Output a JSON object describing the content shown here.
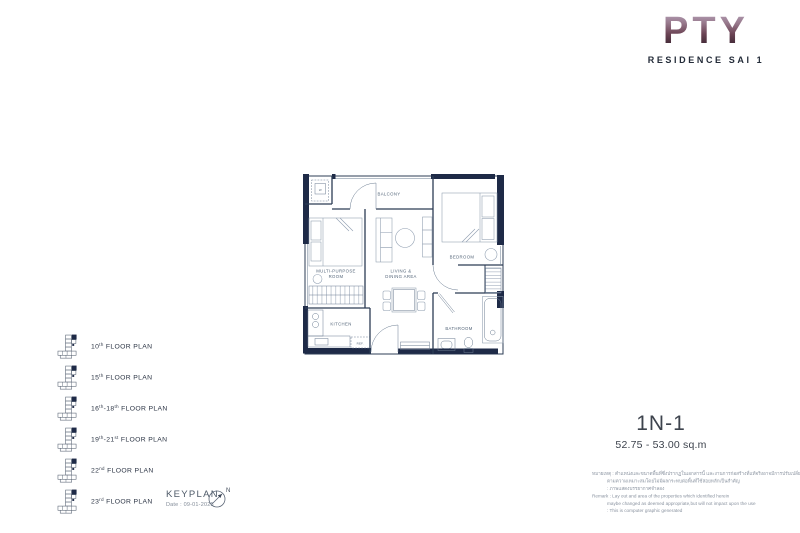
{
  "brand": {
    "name": "PTY",
    "subtitle": "RESIDENCE SAI 1"
  },
  "floor_plans": [
    {
      "parts": [
        {
          "t": "10"
        },
        {
          "t": "th",
          "sup": true
        },
        {
          "t": " FLOOR PLAN"
        }
      ]
    },
    {
      "parts": [
        {
          "t": "15"
        },
        {
          "t": "th",
          "sup": true
        },
        {
          "t": " FLOOR PLAN"
        }
      ]
    },
    {
      "parts": [
        {
          "t": "16"
        },
        {
          "t": "th",
          "sup": true
        },
        {
          "t": "-18"
        },
        {
          "t": "th",
          "sup": true
        },
        {
          "t": " FLOOR PLAN"
        }
      ]
    },
    {
      "parts": [
        {
          "t": "19"
        },
        {
          "t": "th",
          "sup": true
        },
        {
          "t": "-21"
        },
        {
          "t": "st",
          "sup": true
        },
        {
          "t": " FLOOR PLAN"
        }
      ]
    },
    {
      "parts": [
        {
          "t": "22"
        },
        {
          "t": "nd",
          "sup": true
        },
        {
          "t": " FLOOR PLAN"
        }
      ]
    },
    {
      "parts": [
        {
          "t": "23"
        },
        {
          "t": "rd",
          "sup": true
        },
        {
          "t": " FLOOR PLAN"
        }
      ]
    }
  ],
  "keyplan": {
    "title": "KEYPLAN",
    "date": "Date : 09-01-2025",
    "north": "N"
  },
  "unit": {
    "code": "1N-1",
    "area": "52.75 - 53.00 sq.m"
  },
  "plan": {
    "labels": {
      "balcony": "BALCONY",
      "multipurpose_1": "MULTI-PURPOSE",
      "multipurpose_2": "ROOM",
      "living_1": "LIVING &",
      "living_2": "DINING AREA",
      "bedroom": "BEDROOM",
      "kitchen": "KITCHEN",
      "bathroom": "BATHROOM",
      "washer": "W",
      "ref": "REF."
    }
  },
  "remark": {
    "lines": [
      {
        "text": "หมายเหตุ : ตำแหน่งและขนาดพื้นที่ซึ่งปรากฏในเอกสารนี้ และงานการก่อสร้างที่แท้จริงอาจมีการปรับเปลี่ยนได้",
        "indent": false
      },
      {
        "text": "ตามความเหมาะสมโดยไม่มีผลกระทบต่อพื้นที่ใช้สอยหลักเป็นสำคัญ",
        "indent": true
      },
      {
        "text": ": ภาพแสดงบรรยากาศจำลอง",
        "indent": true
      },
      {
        "text": "Remark : Lay out and area of the properties which identified herein",
        "indent": false
      },
      {
        "text": "maybe changed as deemed appropriate,but will not impact upon the use",
        "indent": true
      },
      {
        "text": ": This is computer graphic generated",
        "indent": true
      }
    ]
  },
  "colors": {
    "wall": "#1e2a47",
    "logo_gradient_top": "#b5a2ba",
    "logo_gradient_bottom": "#2b1c26",
    "label_text": "#55667a"
  }
}
